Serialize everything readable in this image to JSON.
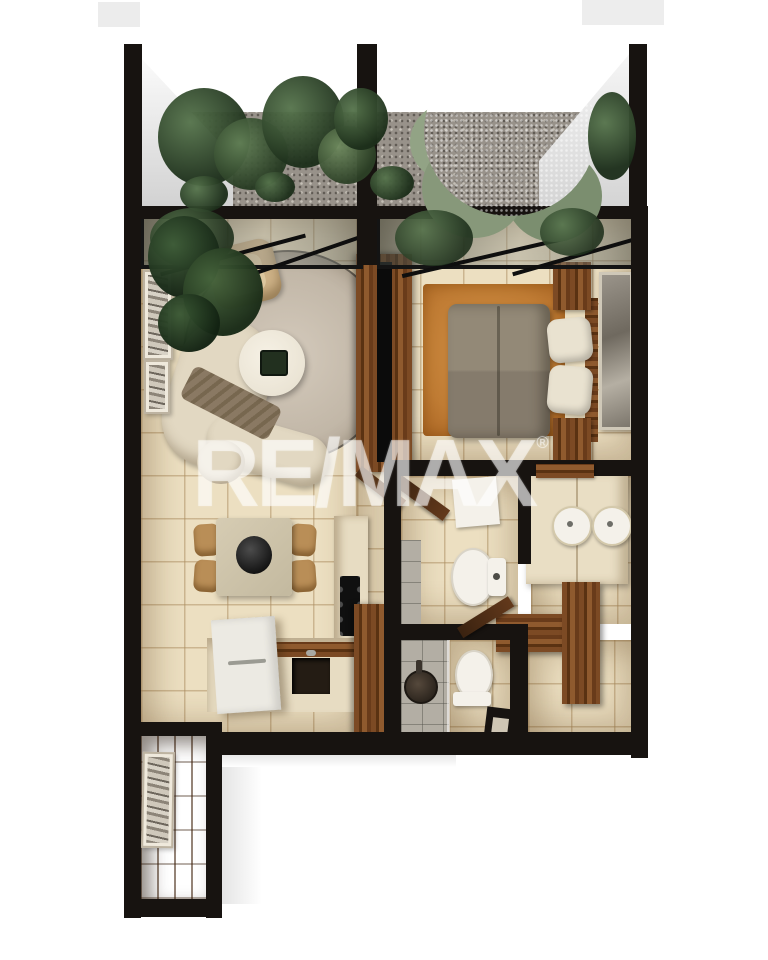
{
  "watermark": {
    "text": "RE/MAX",
    "registered_mark": "®",
    "color": "#ffffff",
    "opacity": 0.52
  },
  "palette": {
    "wall": "#171310",
    "floor_tile": "#ecdfc1",
    "gravel": "#98928a",
    "shower_tile": "#b3aea4",
    "wood_dark": "#4f2f17",
    "wood_mid": "#8a5730",
    "foliage_dark": "#2e422c",
    "foliage_light": "#93a483",
    "rug_living": "#c7bcab",
    "rug_bedroom": "#c07c34",
    "sofa_cream": "#e2d8c2",
    "bed_taupe": "#8d8374",
    "pillow": "#e9e2d0",
    "porcelain": "#f4f1ea"
  }
}
